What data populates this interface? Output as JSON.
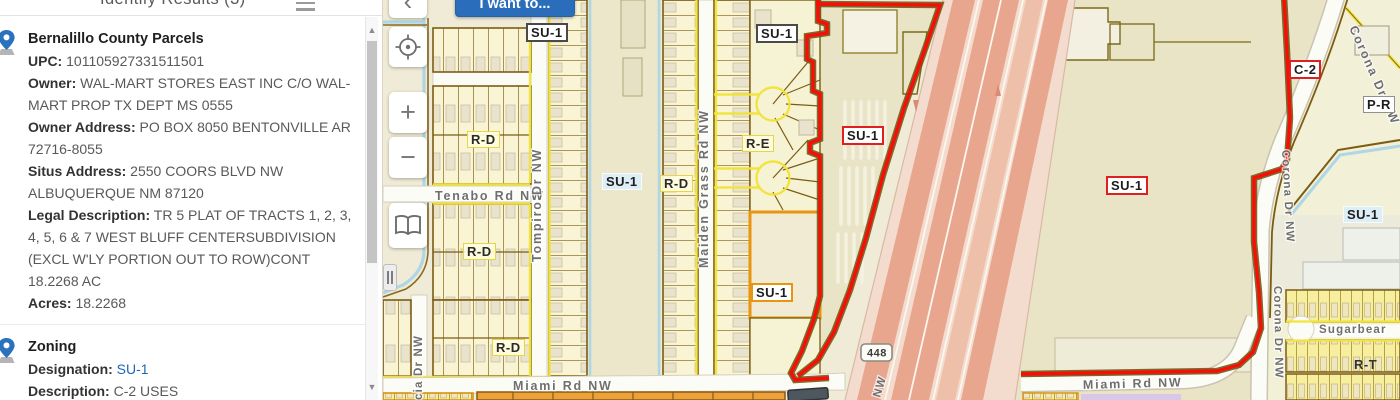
{
  "panel": {
    "title": "Identify Results (3)",
    "scroll_up": "▲",
    "scroll_down": "▼",
    "results": [
      {
        "title": "Bernalillo County Parcels",
        "fields": [
          {
            "label": "UPC:",
            "value": "101105927331511501"
          },
          {
            "label": "Owner:",
            "value": "WAL-MART STORES EAST INC C/O WAL-MART PROP TX DEPT MS 0555"
          },
          {
            "label": "Owner Address:",
            "value": "PO BOX 8050 BENTONVILLE AR 72716-8055"
          },
          {
            "label": "Situs Address:",
            "value": "2550 COORS BLVD NW ALBUQUERQUE NM 87120"
          },
          {
            "label": "Legal Description:",
            "value": "TR 5 PLAT OF TRACTS 1, 2, 3, 4, 5, 6 & 7 WEST BLUFF CENTERSUBDIVISION (EXCL W'LY PORTION OUT TO ROW)CONT 18.2268 AC"
          },
          {
            "label": "Acres:",
            "value": "18.2268"
          }
        ]
      },
      {
        "title": "Zoning",
        "fields": [
          {
            "label": "Designation:",
            "value": "SU-1"
          },
          {
            "label": "Description:",
            "value": "C-2 USES"
          }
        ]
      }
    ]
  },
  "map": {
    "i_want_to": "I want to...",
    "back_chevron": "‹",
    "zoom_in": "+",
    "zoom_out": "−",
    "shield": "448",
    "streets": {
      "tenabo": "Tenabo Rd NW",
      "tompiro": "Tompiro Dr NW",
      "maiden_grass": "Maiden Grass Rd NW",
      "corona_a": "Corona Dr NW",
      "corona_b": "Corona Dr NW",
      "corona_c": "Corona Dr NW",
      "miami_w": "Miami Rd NW",
      "miami_e": "Miami Rd NW",
      "sugarbear": "Sugarbear",
      "cia": "cia Dr NW",
      "coors_nw": "NW"
    },
    "zones": {
      "su1_top_left": "SU-1",
      "su1_top_right": "SU-1",
      "su1_strip": "SU-1",
      "su1_orange": "SU-1",
      "su1_west_sel": "SU-1",
      "su1_big_sel": "SU-1",
      "su1_right": "SU-1",
      "c2": "C-2",
      "pr": "P-R",
      "rd_a": "R-D",
      "rd_b": "R-D",
      "rd_c": "R-D",
      "rd_d": "R-D",
      "re": "R-E",
      "rt": "R-T"
    },
    "colors": {
      "selection_boundary": "#f90d09",
      "accent_button": "#2a6ebb",
      "zone_link": "#1e66b8",
      "residential_fill": "#f9f5d4",
      "commercial_fill": "#e9e4c6",
      "highway_fill": "#e9a68e"
    }
  }
}
